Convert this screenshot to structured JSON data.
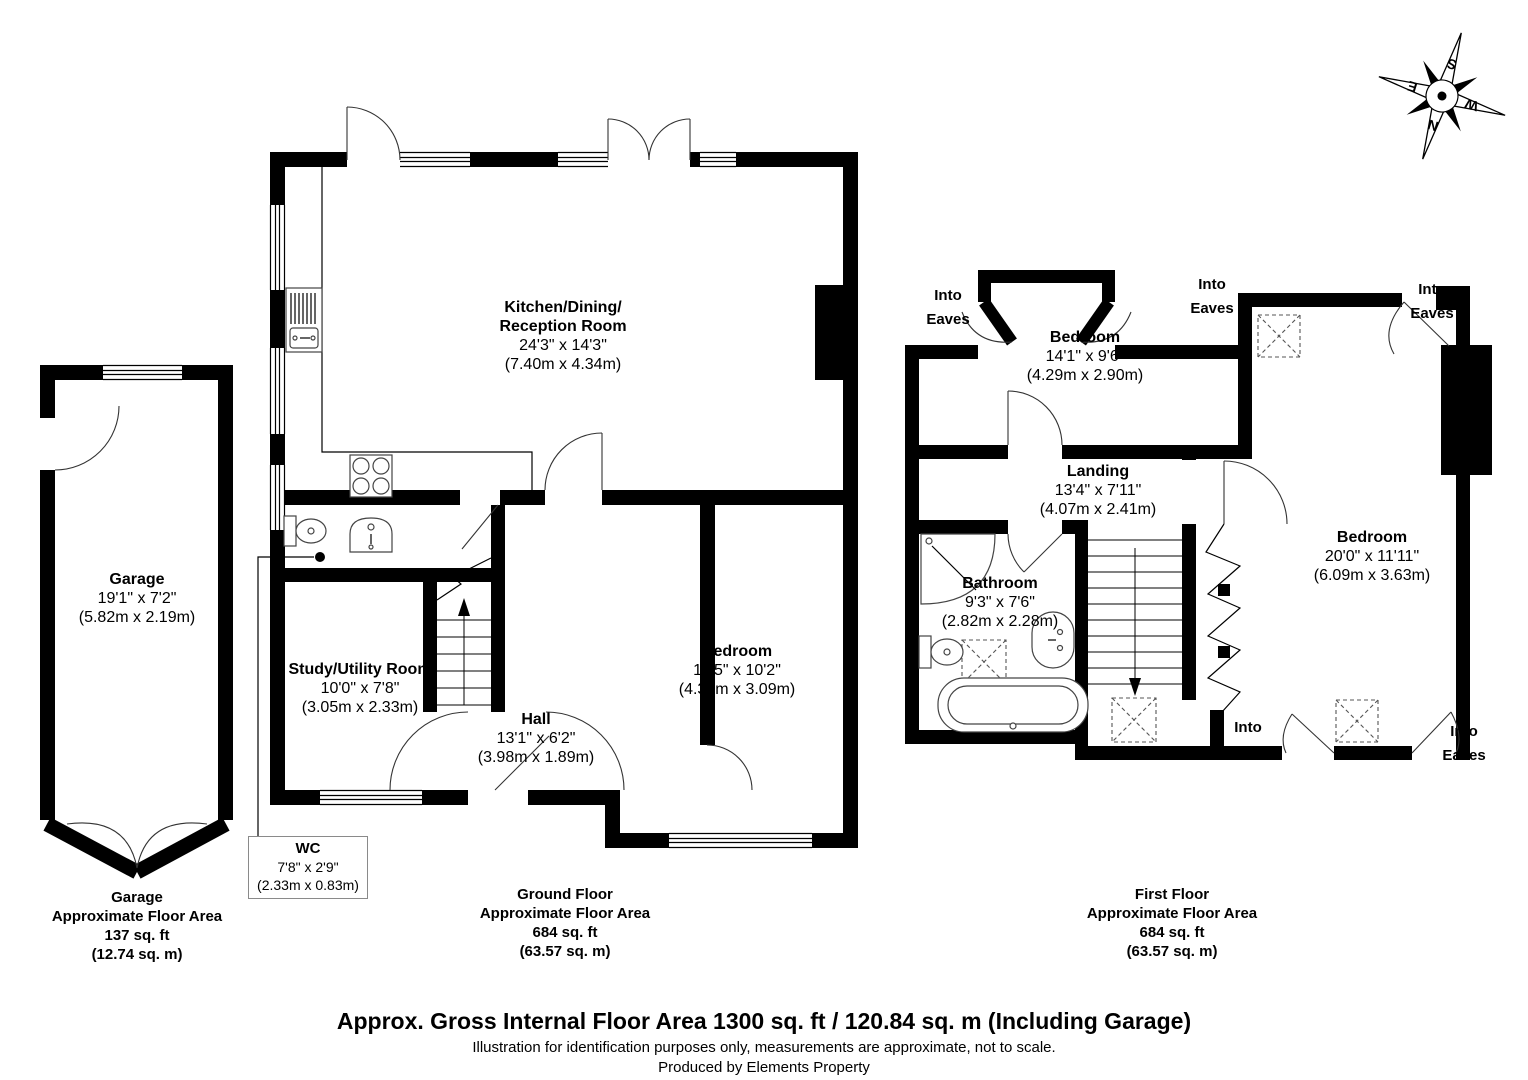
{
  "compass": {
    "n": "N",
    "e": "E",
    "s": "S",
    "w": "W"
  },
  "rooms": {
    "kitchen": {
      "name_line1": "Kitchen/Dining/",
      "name_line2": "Reception Room",
      "imperial": "24'3\" x 14'3\"",
      "metric": "(7.40m x 4.34m)"
    },
    "garage": {
      "name": "Garage",
      "imperial": "19'1\" x 7'2\"",
      "metric": "(5.82m x 2.19m)"
    },
    "study": {
      "name": "Study/Utility Room",
      "imperial": "10'0\" x 7'8\"",
      "metric": "(3.05m x 2.33m)"
    },
    "hall": {
      "name": "Hall",
      "imperial": "13'1\" x 6'2\"",
      "metric": "(3.98m x 1.89m)"
    },
    "wc": {
      "name": "WC",
      "imperial": "7'8\" x 2'9\"",
      "metric": "(2.33m x 0.83m)"
    },
    "bedroom_ground": {
      "name": "Bedroom",
      "imperial": "14'5\" x 10'2\"",
      "metric": "(4.39m x 3.09m)"
    },
    "bedroom_front": {
      "name": "Bedroom",
      "imperial": "14'1\" x 9'6\"",
      "metric": "(4.29m x 2.90m)"
    },
    "landing": {
      "name": "Landing",
      "imperial": "13'4\" x 7'11\"",
      "metric": "(4.07m x 2.41m)"
    },
    "bathroom": {
      "name": "Bathroom",
      "imperial": "9'3\" x 7'6\"",
      "metric": "(2.82m x 2.28m)"
    },
    "bedroom_first": {
      "name": "Bedroom",
      "imperial": "20'0\" x 11'11\"",
      "metric": "(6.09m x 3.63m)"
    }
  },
  "eaves": {
    "line1": "Into",
    "line2": "Eaves"
  },
  "areas": {
    "garage": {
      "title": "Garage",
      "subtitle": "Approximate Floor Area",
      "imperial": "137 sq. ft",
      "metric": "(12.74 sq. m)"
    },
    "ground": {
      "title": "Ground Floor",
      "subtitle": "Approximate Floor Area",
      "imperial": "684 sq. ft",
      "metric": "(63.57 sq. m)"
    },
    "first": {
      "title": "First Floor",
      "subtitle": "Approximate Floor Area",
      "imperial": "684 sq. ft",
      "metric": "(63.57 sq. m)"
    }
  },
  "footer": {
    "line1": "Approx. Gross Internal Floor Area 1300 sq. ft / 120.84 sq. m (Including Garage)",
    "line2": "Illustration for identification purposes only, measurements are approximate, not to scale.",
    "line3": "Produced by Elements Property"
  }
}
